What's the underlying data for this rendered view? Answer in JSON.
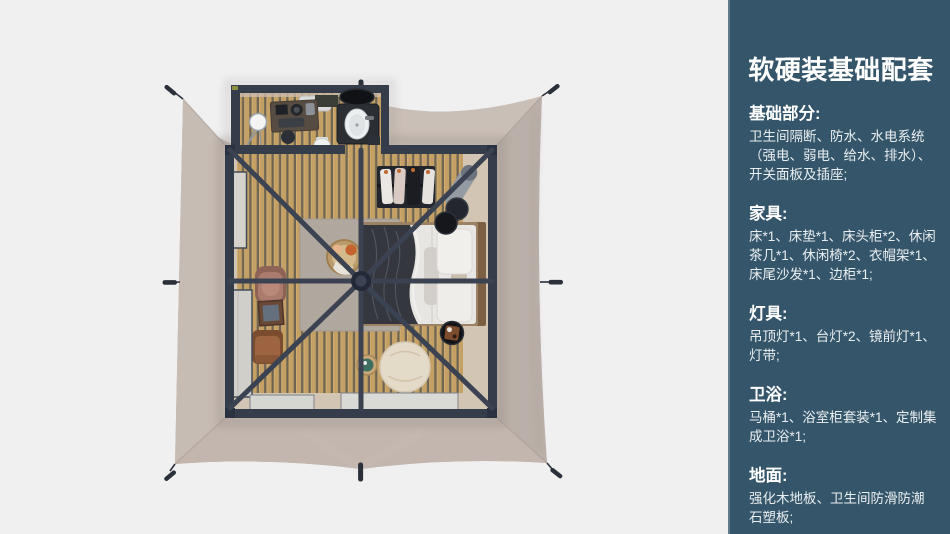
{
  "panel": {
    "title": "软硬装基础配套",
    "sections": [
      {
        "heading": "基础部分:",
        "body": "卫生间隔断、防水、水电系统（强电、弱电、给水、排水）、开关面板及插座;"
      },
      {
        "heading": "家具:",
        "body": "床*1、床垫*1、床头柜*2、休闲茶几*1、休闲椅*2、衣帽架*1、床尾沙发*1、边柜*1;"
      },
      {
        "heading": "灯具:",
        "body": "吊顶灯*1、台灯*2、镜前灯*1、灯带;"
      },
      {
        "heading": "卫浴:",
        "body": "马桶*1、浴室柜套装*1、定制集成卫浴*1;"
      },
      {
        "heading": "地面:",
        "body": "强化木地板、卫生间防滑防潮石塑板;"
      }
    ]
  },
  "render": {
    "alt": "Top-down 3D render of a square glamping tent: beige canopy with corner stakes, dark metal frame bedroom with bed, wardrobe rack, chairs, beanbag and a bathroom annex",
    "items": [
      "tent-canopy",
      "frame-room",
      "bathroom-annex",
      "bed",
      "clothes-rack",
      "leisure-chairs",
      "beanbag",
      "side-tables",
      "wood-floor",
      "rug"
    ]
  },
  "theme": {
    "page_bg": "#f0f0f1",
    "panel_bg": "#35566a",
    "panel_text": "#e9eef1",
    "panel_title": "#ffffff",
    "frame": "#353c4a",
    "fabric": "#c5bab2",
    "wood_light": "#c4a065",
    "wood_dark": "#6f6553",
    "bedding": "#e8e6e3",
    "rug": "#b0a79f"
  }
}
